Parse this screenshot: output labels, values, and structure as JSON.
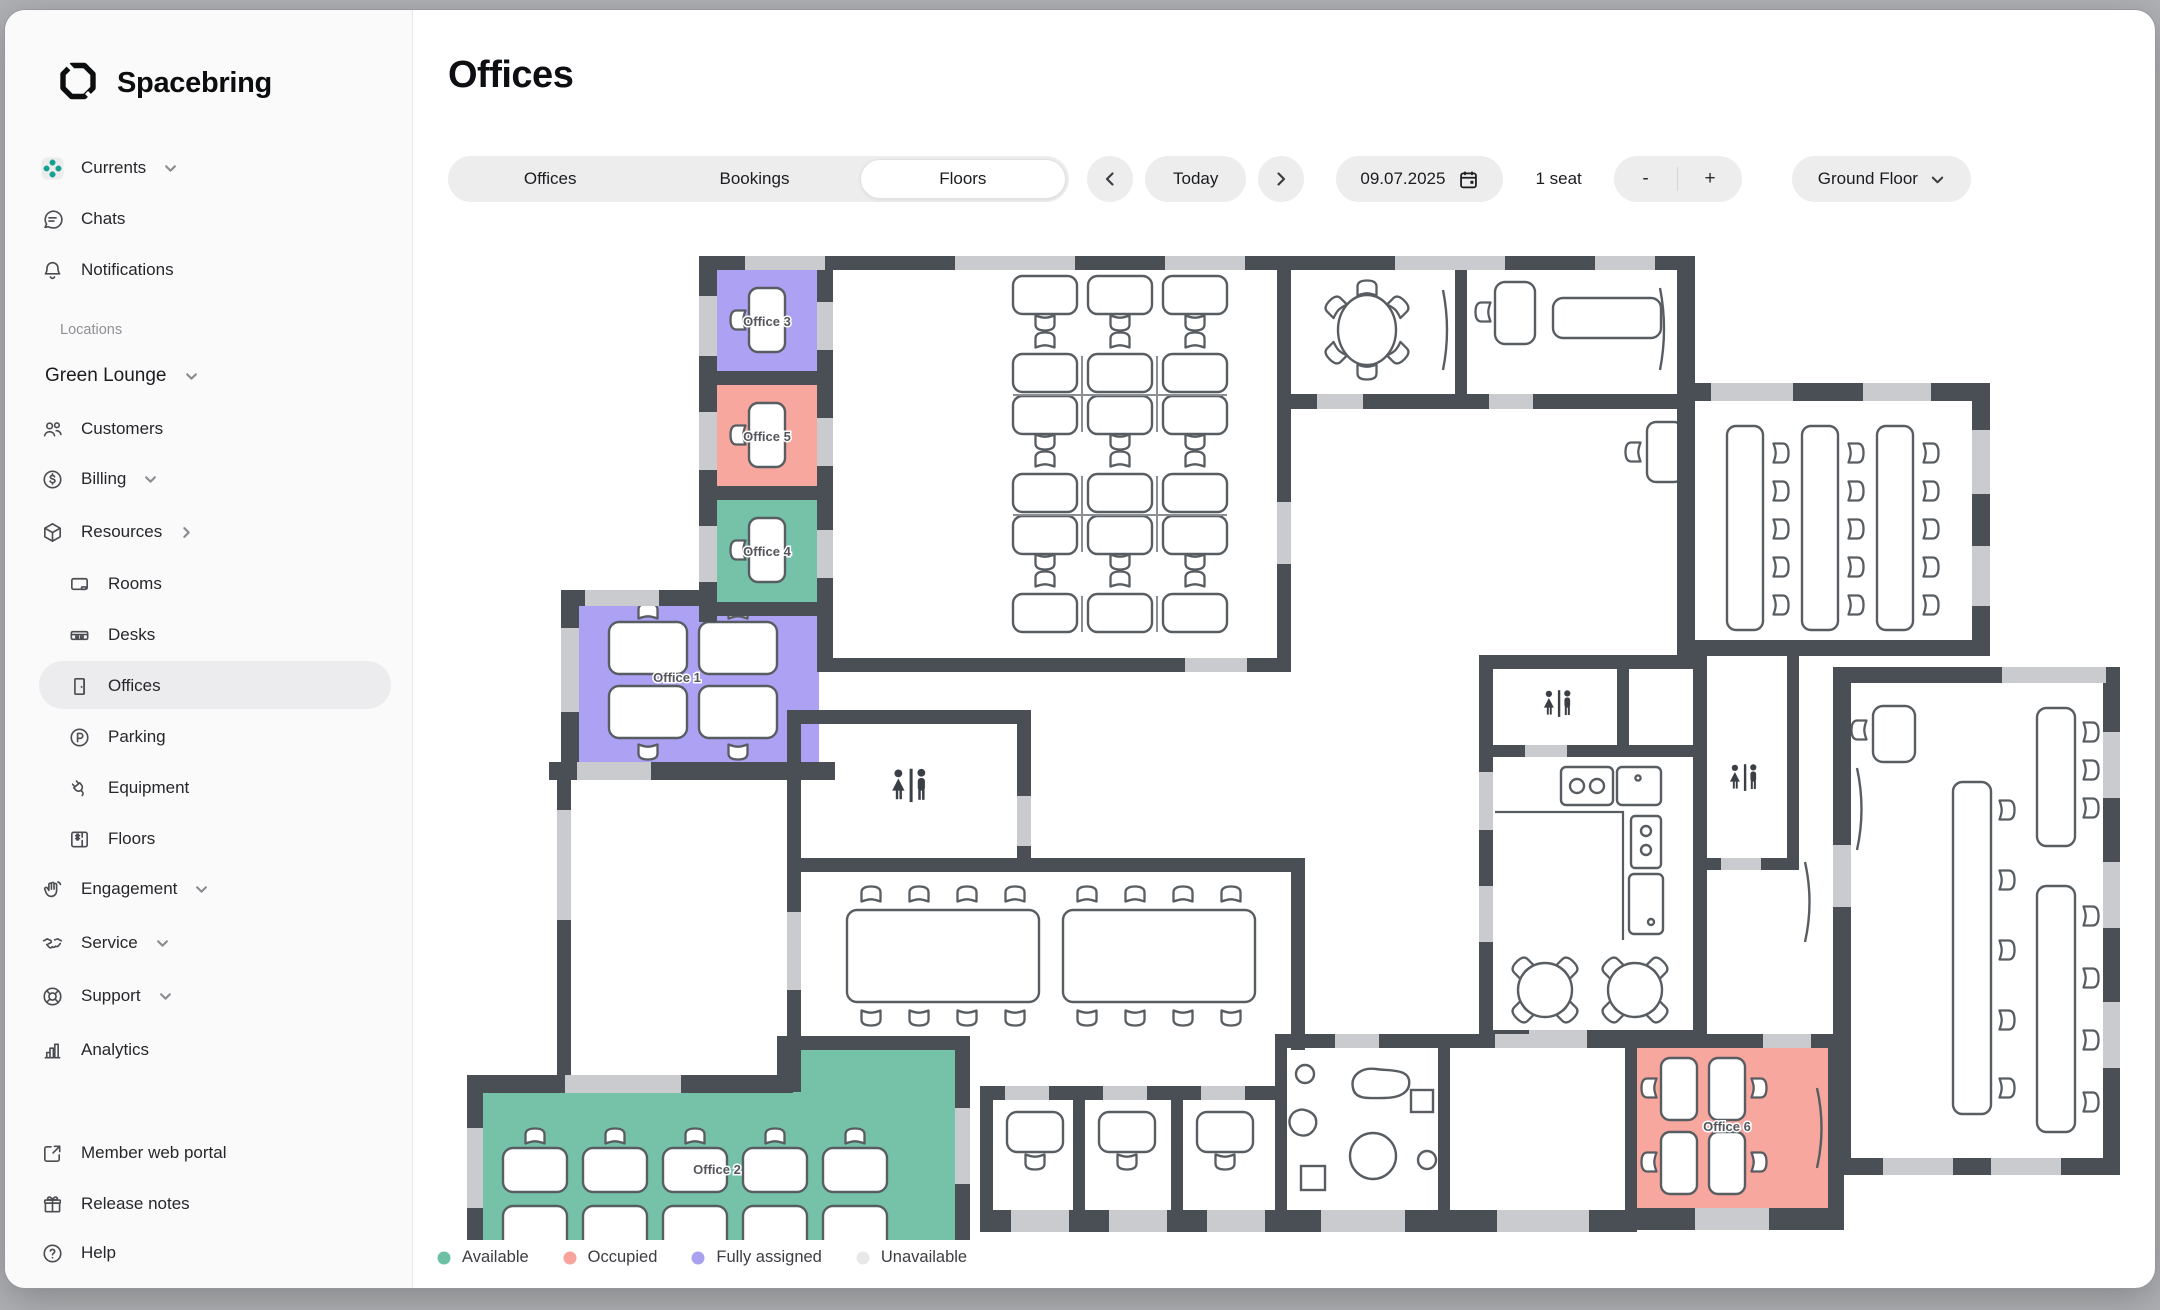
{
  "sidebar": {
    "brand": "Spacebring",
    "nav_top": [
      {
        "label": "Currents"
      },
      {
        "label": "Chats"
      },
      {
        "label": "Notifications"
      }
    ],
    "locations_label": "Locations",
    "location_name": "Green Lounge",
    "nav_location": [
      {
        "label": "Customers"
      },
      {
        "label": "Billing"
      },
      {
        "label": "Resources"
      }
    ],
    "nav_resources": [
      {
        "label": "Rooms"
      },
      {
        "label": "Desks"
      },
      {
        "label": "Offices"
      },
      {
        "label": "Parking"
      },
      {
        "label": "Equipment"
      },
      {
        "label": "Floors"
      }
    ],
    "nav_modules": [
      {
        "label": "Engagement"
      },
      {
        "label": "Service"
      },
      {
        "label": "Support"
      },
      {
        "label": "Analytics"
      }
    ],
    "nav_footer": [
      {
        "label": "Member web portal"
      },
      {
        "label": "Release notes"
      },
      {
        "label": "Help"
      }
    ]
  },
  "header": {
    "title": "Offices"
  },
  "toolbar": {
    "tabs": [
      {
        "label": "Offices"
      },
      {
        "label": "Bookings"
      },
      {
        "label": "Floors"
      }
    ],
    "active_tab": "Floors",
    "today_label": "Today",
    "date_value": "09.07.2025",
    "seats_label": "1 seat",
    "minus_label": "-",
    "plus_label": "+",
    "floor_selector": "Ground Floor"
  },
  "floorplan": {
    "offices": [
      {
        "label": "Office 3",
        "status": "fully_assigned",
        "color": "#aca1f2"
      },
      {
        "label": "Office 5",
        "status": "occupied",
        "color": "#f8a79f"
      },
      {
        "label": "Office 4",
        "status": "available",
        "color": "#75c2a9"
      },
      {
        "label": "Office 1",
        "status": "fully_assigned",
        "color": "#aca1f2"
      },
      {
        "label": "Office 2",
        "status": "available",
        "color": "#75c2a9"
      },
      {
        "label": "Office 6",
        "status": "occupied",
        "color": "#f8a79f"
      }
    ]
  },
  "legend": {
    "items": [
      {
        "label": "Available",
        "color": "#6ec0a5"
      },
      {
        "label": "Occupied",
        "color": "#f8a49c"
      },
      {
        "label": "Fully assigned",
        "color": "#a9a0f0"
      },
      {
        "label": "Unavailable",
        "color": "#e8e8ea"
      }
    ]
  }
}
